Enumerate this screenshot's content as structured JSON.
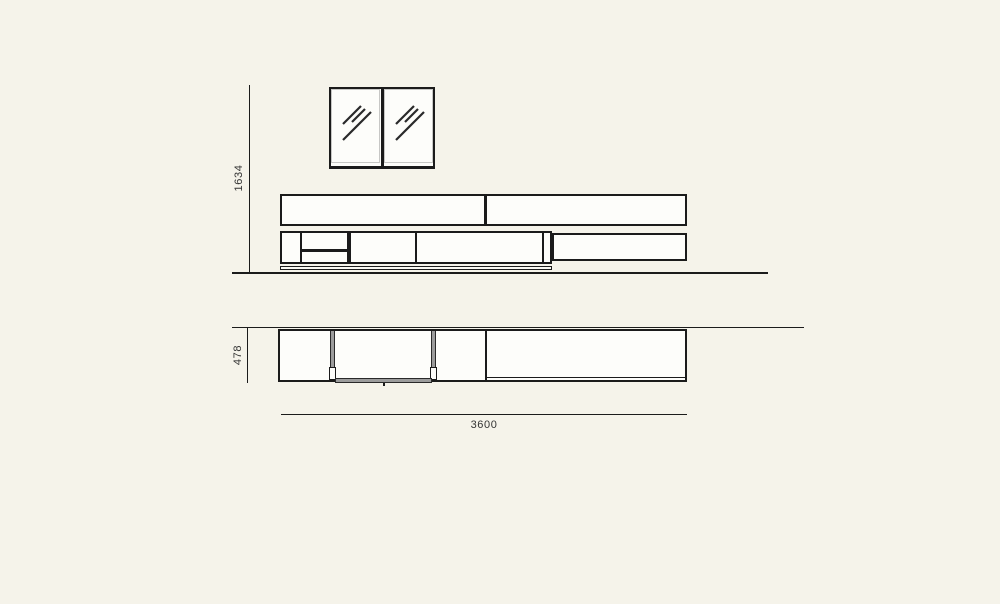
{
  "colors": {
    "background": "#f5f3ea",
    "line": "#1b1b1b",
    "panel_gray": "#9c9c9c",
    "label_text": "#333333"
  },
  "dimensions": {
    "height_label": "1634",
    "depth_label": "478",
    "width_label": "3600"
  }
}
